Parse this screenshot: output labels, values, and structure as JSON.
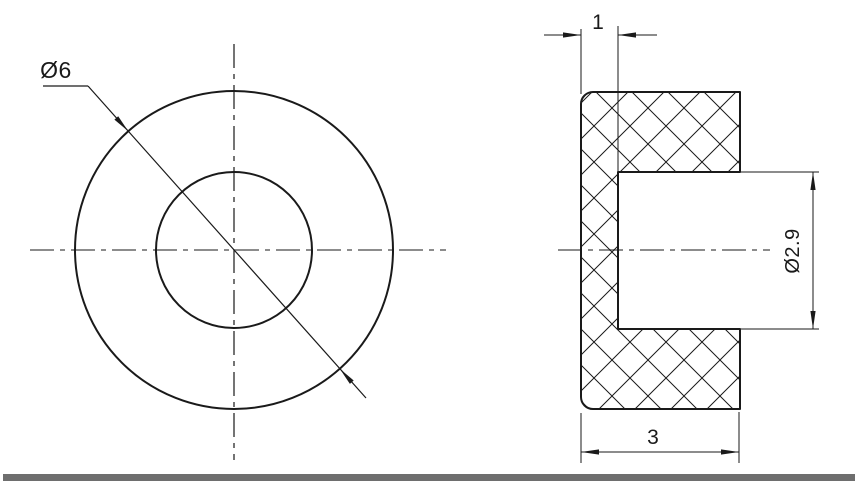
{
  "drawing": {
    "labels": {
      "outer_diameter": "Ø6",
      "end_wall_thickness": "1",
      "bore_diameter": "Ø2.9",
      "overall_length": "3"
    },
    "colors": {
      "line": "#1a1a1a",
      "centerline_gray": "#8c8c8c",
      "separator_bar": "#6e6e6e",
      "background": "#ffffff"
    }
  }
}
